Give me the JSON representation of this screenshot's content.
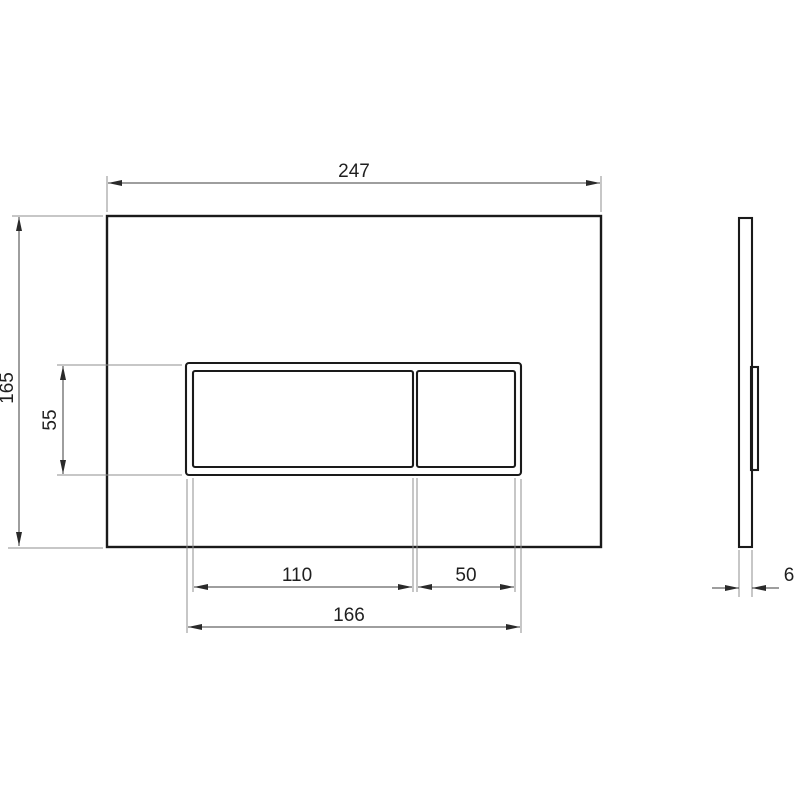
{
  "drawing": {
    "kind": "technical-dimension-drawing",
    "subject": "flush-plate",
    "views": {
      "front_view": "flush plate front elevation",
      "side_view": "flush plate side profile"
    },
    "dimensions": {
      "plate_width": "247",
      "plate_height": "165",
      "button_area_height": "55",
      "large_button_width": "110",
      "small_button_width": "50",
      "button_area_width": "166",
      "plate_thickness": "6"
    },
    "colors": {
      "background": "#ffffff",
      "part_outline": "#1a1a1a",
      "dimension_line": "#3c3c3c",
      "extension_line": "#8f8f8f",
      "dimension_text": "#1f1f1f"
    }
  }
}
